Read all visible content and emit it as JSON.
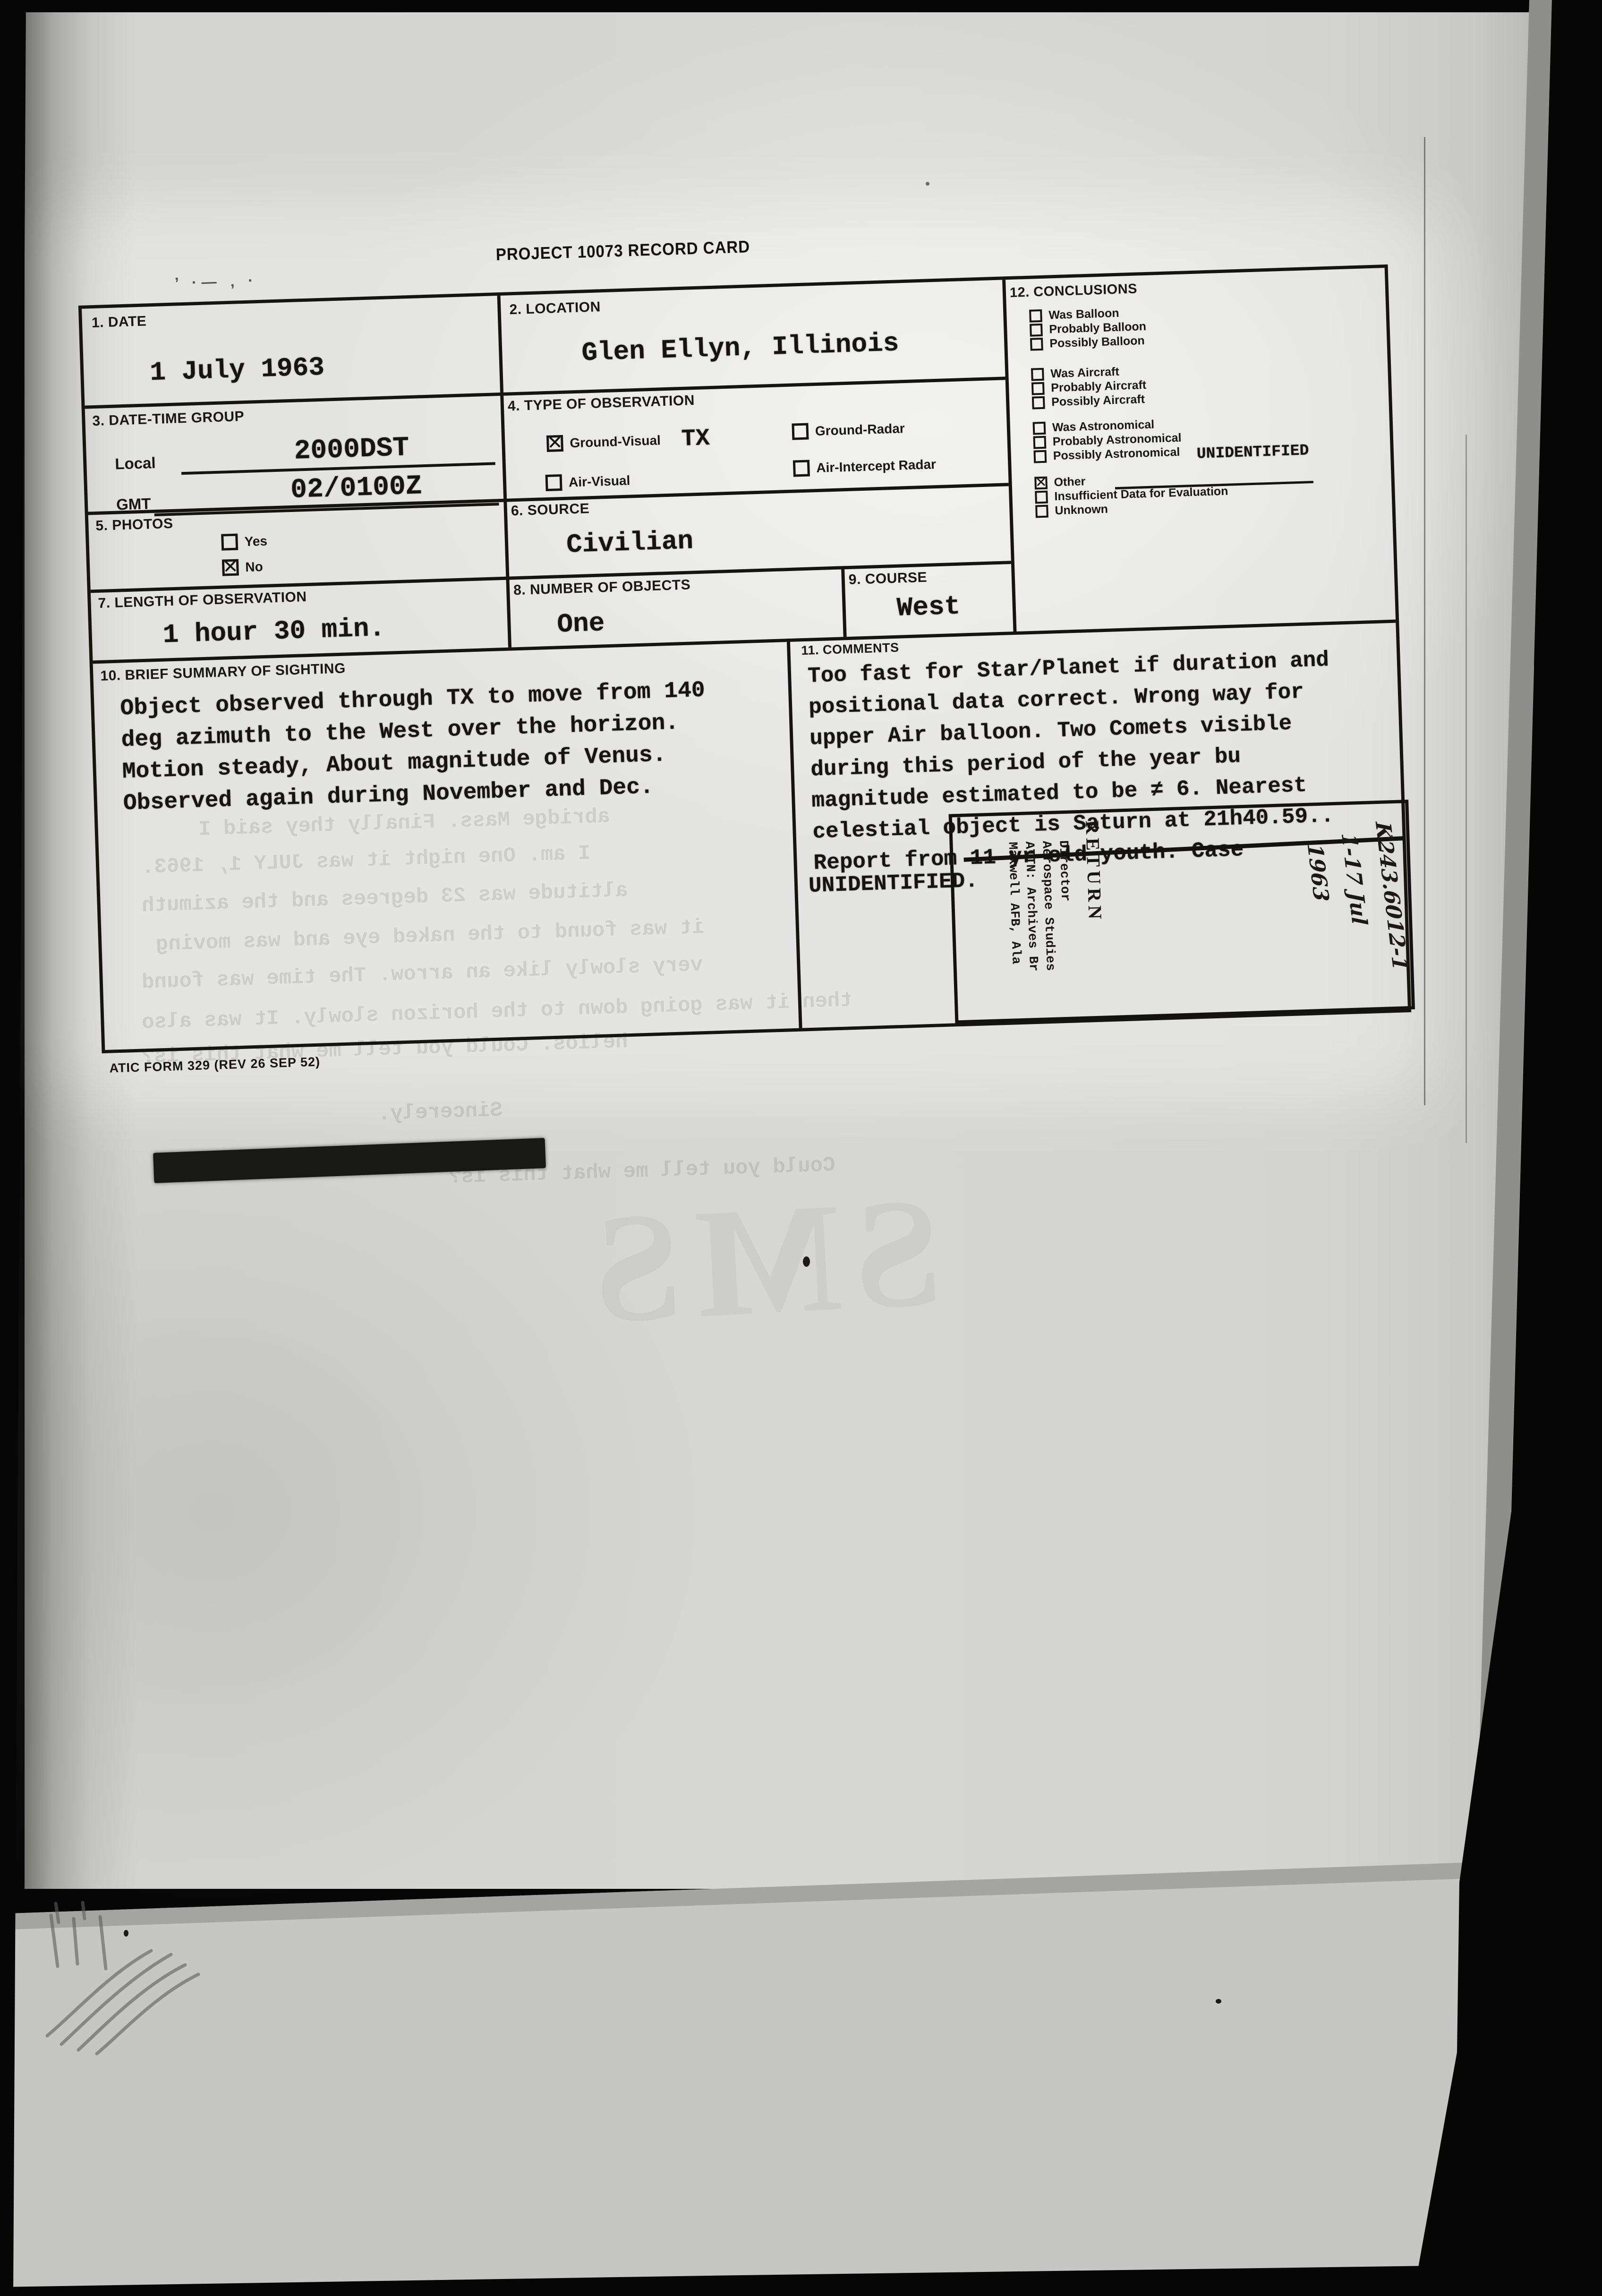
{
  "page": {
    "title": "PROJECT 10073 RECORD CARD",
    "form_number": "ATIC FORM 329 (REV 26 SEP 52)",
    "margin_marks": "’ ·— ‚ ·",
    "sections": {
      "date": {
        "label": "1. DATE",
        "value": "1 July 1963"
      },
      "location": {
        "label": "2. LOCATION",
        "value": "Glen Ellyn, Illinois"
      },
      "date_time_group": {
        "label": "3. DATE-TIME GROUP",
        "local_label": "Local",
        "local_value": "2000DST",
        "gmt_label": "GMT",
        "gmt_value": "02/0100Z"
      },
      "type_of_observation": {
        "label": "4. TYPE OF OBSERVATION",
        "options": [
          {
            "label": "Ground-Visual",
            "checked": true,
            "note": "TX"
          },
          {
            "label": "Air-Visual",
            "checked": false
          },
          {
            "label": "Ground-Radar",
            "checked": false
          },
          {
            "label": "Air-Intercept Radar",
            "checked": false
          }
        ]
      },
      "photos": {
        "label": "5. PHOTOS",
        "options": [
          {
            "label": "Yes",
            "checked": false
          },
          {
            "label": "No",
            "checked": true
          }
        ]
      },
      "source": {
        "label": "6. SOURCE",
        "value": "Civilian"
      },
      "length_of_observation": {
        "label": "7. LENGTH OF OBSERVATION",
        "value": "1 hour 30 min."
      },
      "number_of_objects": {
        "label": "8. NUMBER OF OBJECTS",
        "value": "One"
      },
      "course": {
        "label": "9. COURSE",
        "value": "West"
      },
      "brief_summary": {
        "label": "10. BRIEF SUMMARY OF SIGHTING",
        "lines": [
          "Object observed through TX to move from 140",
          "deg azimuth to the West over the horizon.",
          "Motion steady,  About magnitude of Venus.",
          "Observed again during November and Dec."
        ]
      },
      "comments": {
        "label": "11. COMMENTS",
        "lines": [
          "Too fast for Star/Planet if duration and",
          "positional data correct. Wrong way for",
          "upper Air balloon. Two Comets visible",
          "during this period of the year bu",
          "magnitude estimated to be ≠ 6.  Nearest",
          "celestial object is Saturn at 21h40.59.."
        ],
        "report_prefix": "Report from ",
        "struck_text": "11 yr old youth. Case",
        "case_result": "UNIDENTIFIED."
      },
      "conclusions": {
        "label": "12. CONCLUSIONS",
        "items": [
          {
            "label": "Was Balloon",
            "checked": false
          },
          {
            "label": "Probably Balloon",
            "checked": false
          },
          {
            "label": "Possibly Balloon",
            "checked": false
          },
          {
            "label": "Was Aircraft",
            "checked": false
          },
          {
            "label": "Probably Aircraft",
            "checked": false
          },
          {
            "label": "Possibly Aircraft",
            "checked": false
          },
          {
            "label": "Was Astronomical",
            "checked": false
          },
          {
            "label": "Probably Astronomical",
            "checked": false
          },
          {
            "label": "Possibly Astronomical",
            "checked": false
          },
          {
            "label": "Other",
            "checked": true,
            "value": "UNIDENTIFIED"
          },
          {
            "label": "Insufficient Data for Evaluation",
            "checked": false
          },
          {
            "label": "Unknown",
            "checked": false
          }
        ]
      }
    },
    "stamp": {
      "handwritten_lines": [
        "K243.6012-1",
        "1-17 Jul",
        "1963"
      ],
      "return_label": "RETURN",
      "address_lines": [
        "Director",
        "Aerospace Studies",
        "ATTN: Archives Br",
        "Maxwell AFB, Ala"
      ]
    },
    "bleedthrough": {
      "lines": [
        "abridge Mass. Finally they said I",
        "I am. One night it was JULY 1, 1963.",
        "altitude was 23 degrees and the azimuth",
        "it was found to the naked eye and was moving",
        "very slowly like an arrow. The time was found",
        "then it was going down to the horizon slowly. It was also",
        "helios. Could you tell me what this is?",
        "Sincerely.",
        "Could you tell me what this is?",
        "SMS"
      ]
    },
    "colors": {
      "paper": "#d6d6d3",
      "under_sheet": "#c6c6c3",
      "ink": "#17140f",
      "background": "#060606"
    }
  }
}
